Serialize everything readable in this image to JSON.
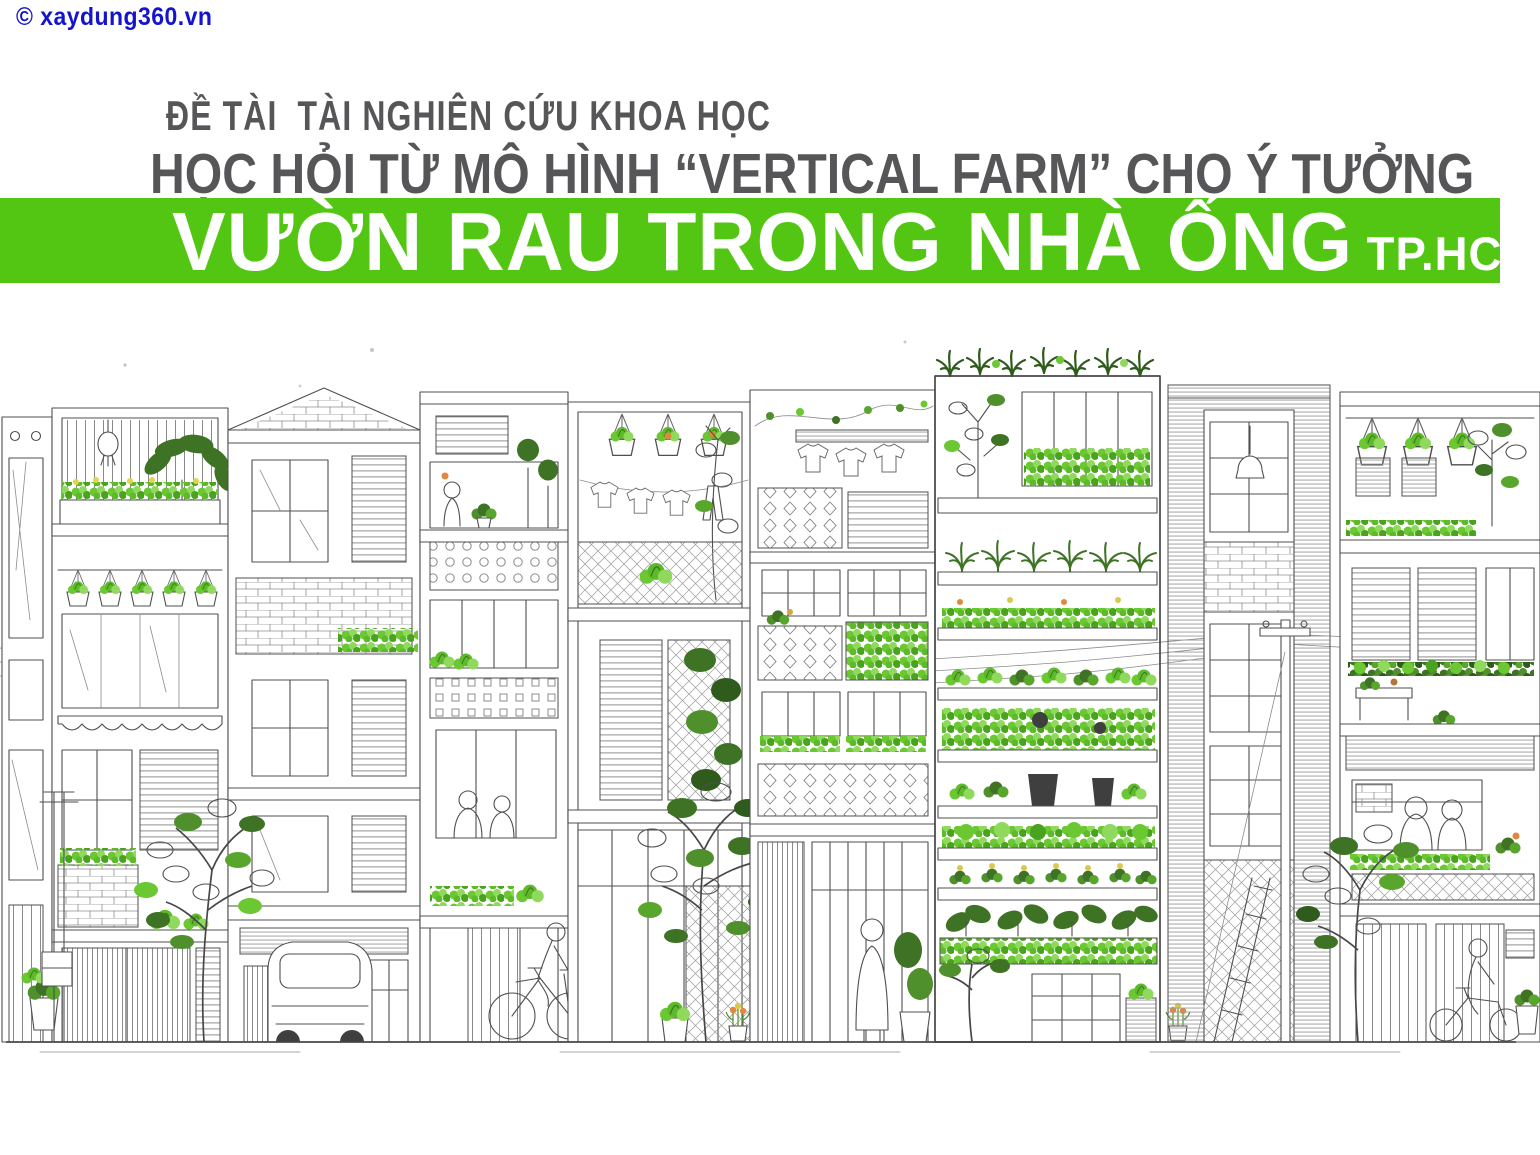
{
  "page": {
    "width_px": 1540,
    "height_px": 1155,
    "background": "#ffffff"
  },
  "watermark": {
    "text": "© xaydung360.vn",
    "color": "#1414cf"
  },
  "header": {
    "kicker": "ĐỀ TÀI  TÀI NGHIÊN CỨU KHOA HỌC",
    "title": "HỌC HỎI TỪ MÔ HÌNH “VERTICAL FARM” CHO Ý TƯỞNG",
    "text_color": "#565558"
  },
  "banner": {
    "text": "VƯỜN RAU TRONG NHÀ ỐNG",
    "suffix": "TP.HCM",
    "background": "#52c613",
    "text_color": "#ffffff"
  },
  "illustration": {
    "alt": "Hand-drawn street elevation of Vietnamese tube houses with balconies, hanging plant pots, laundry lines, perforated block screens, street trees, a parked car, a cyclist, a scooter rider, utility poles with sagging wires, and a multi-storey vertical-farm tower whose shelves are filled with green vegetables.",
    "ink_color": "#4f4f4f",
    "leaf_bright": "#6cc832",
    "leaf_light": "#8fd95c",
    "leaf_dark": "#3e7224"
  }
}
